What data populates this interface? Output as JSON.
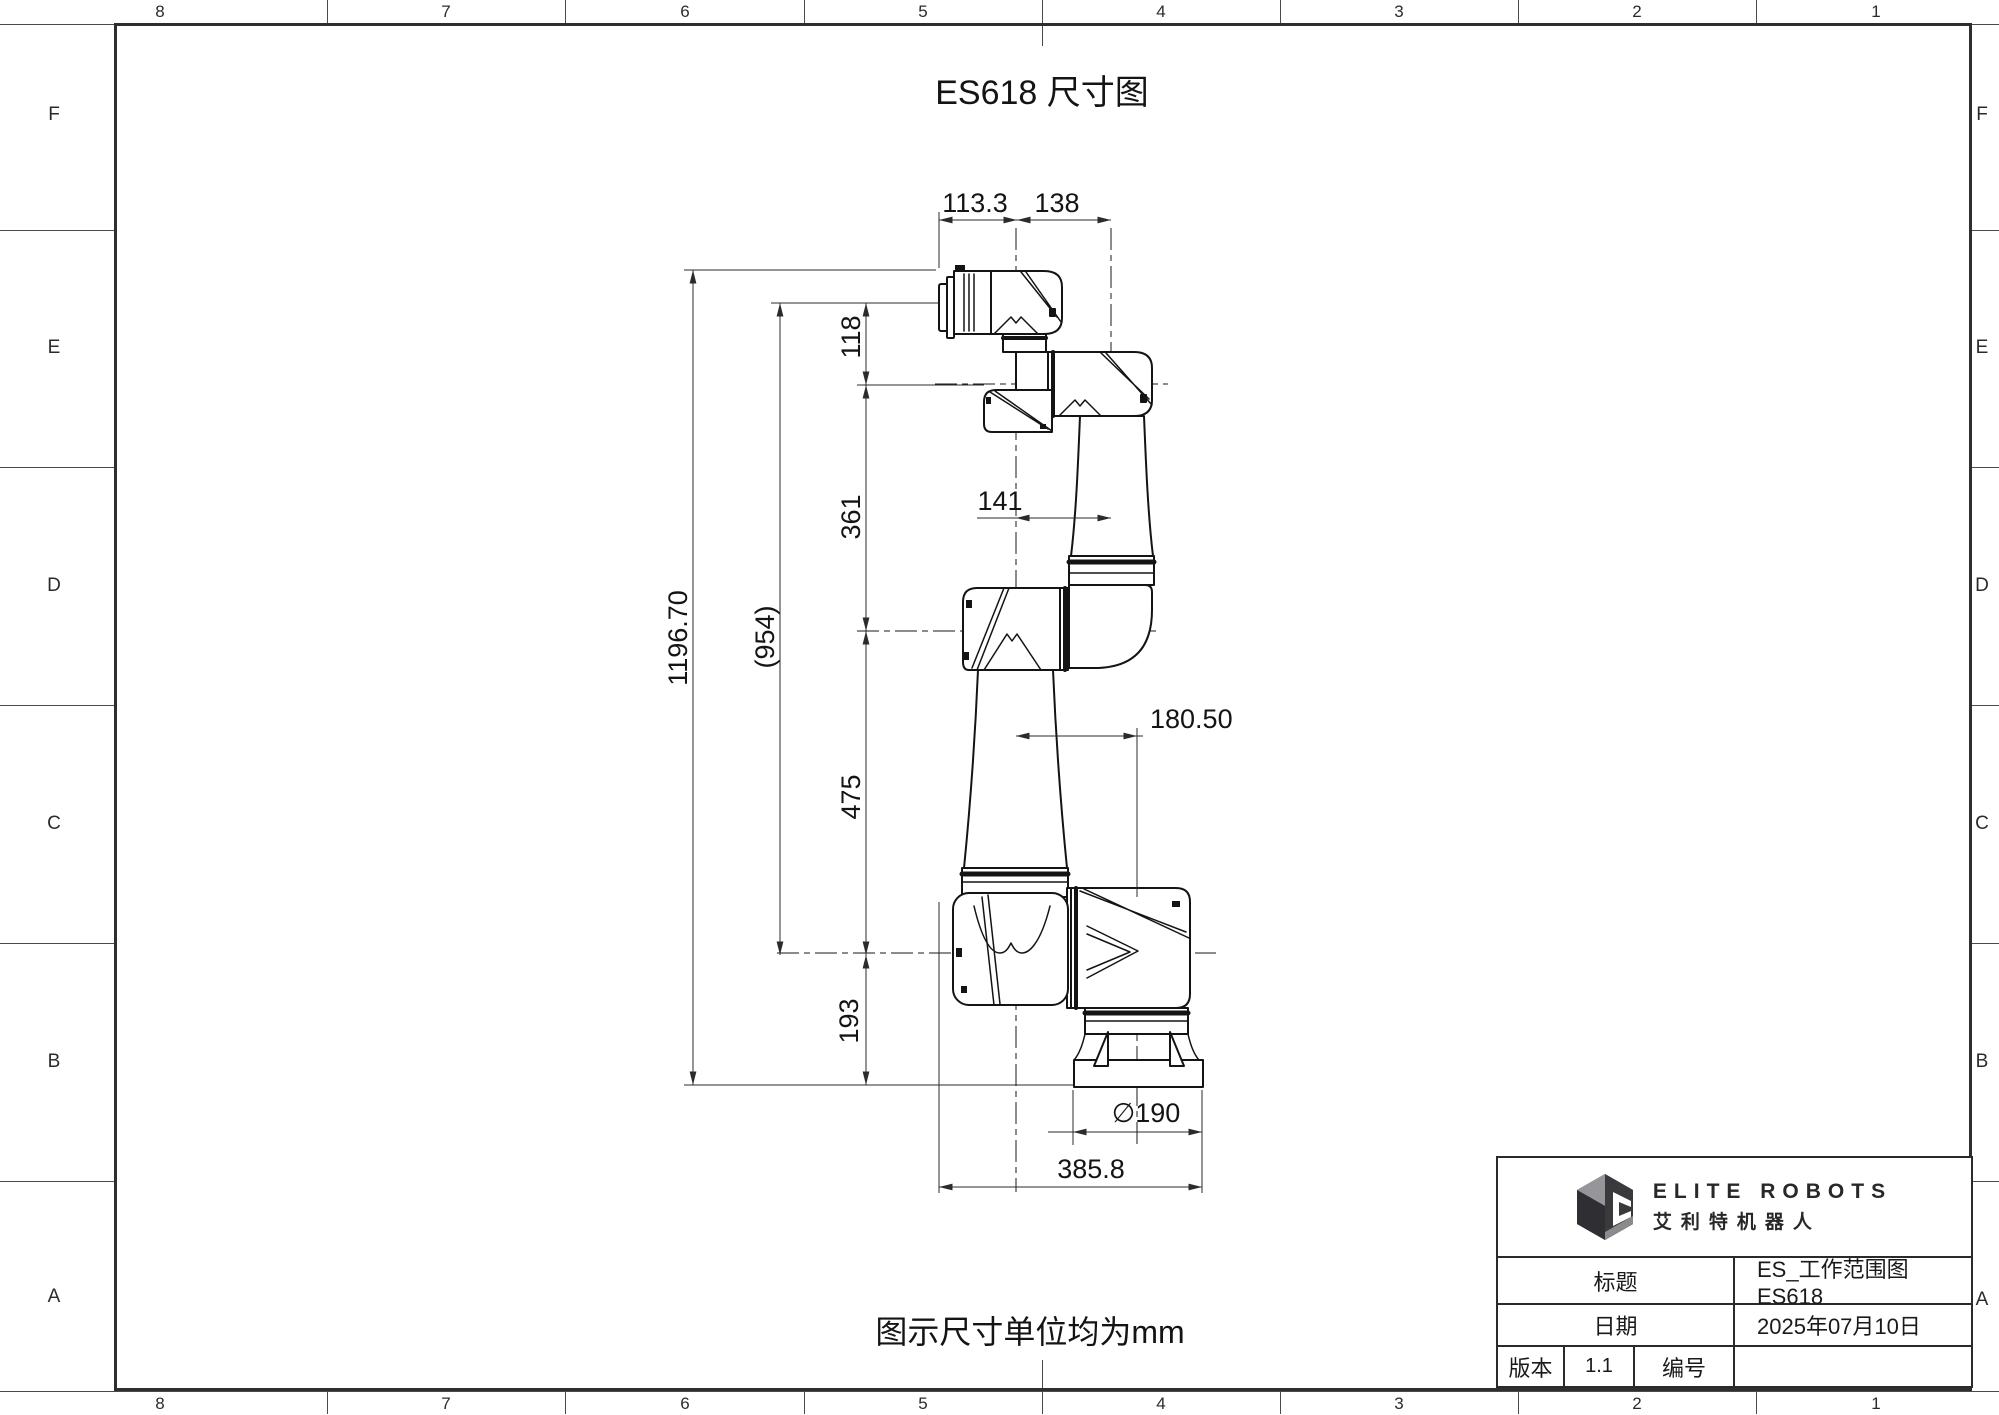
{
  "sheet": {
    "title": "ES618 尺寸图",
    "note": "图示尺寸单位均为mm",
    "grid_columns": [
      "8",
      "7",
      "6",
      "5",
      "4",
      "3",
      "2",
      "1"
    ],
    "grid_rows": [
      "F",
      "E",
      "D",
      "C",
      "B",
      "A"
    ]
  },
  "dimensions": {
    "top_left_width": "113.3",
    "top_right_width": "138",
    "wrist_spacing": "118",
    "forearm_length": "361",
    "overall_height": "1196.70",
    "reference_height": "(954)",
    "elbow_offset": "141",
    "upper_arm_length": "475",
    "shoulder_offset": "180.50",
    "base_height": "193",
    "base_diameter": "∅190",
    "overall_width": "385.8"
  },
  "title_block": {
    "brand_en": "ELITE ROBOTS",
    "brand_cn": "艾利特机器人",
    "label_title": "标题",
    "value_title": "ES_工作范围图 ES618",
    "label_date": "日期",
    "value_date": "2025年07月10日",
    "label_version": "版本",
    "value_version": "1.1",
    "label_number": "编号",
    "value_number": ""
  }
}
